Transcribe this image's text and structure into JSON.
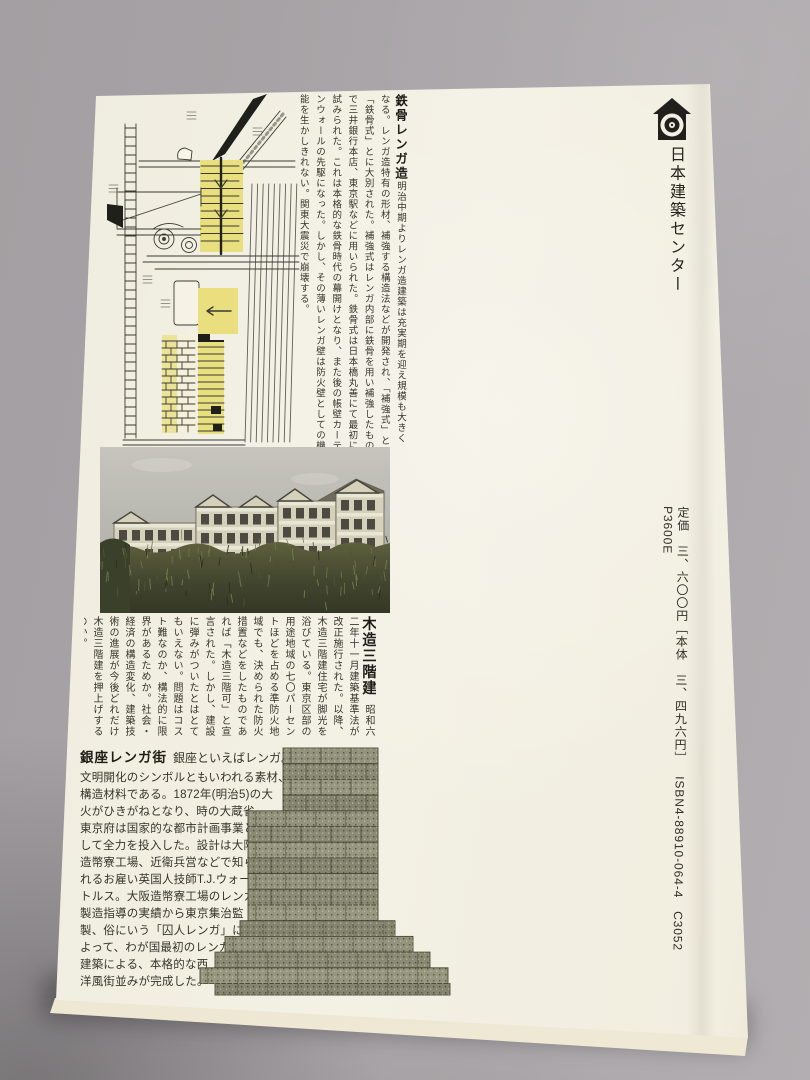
{
  "scene": {
    "backdrop_color": "#a7a3a6",
    "cover_color": "#f2efe2",
    "highlight_yellow": "#e9df7e",
    "brick_color": "#8e8e79"
  },
  "publisher": {
    "name": "日本建築センター",
    "logo_icon": "house-target-logo"
  },
  "colophon": {
    "price": "定価　三、六〇〇円［本体　三、四九六円］",
    "isbn": "ISBN4-88910-064-4　C3052　P3600E"
  },
  "articles": {
    "tekkotsu": {
      "title": "鉄骨レンガ造",
      "body": "明治中期よりレンガ造建築は充実期を迎え規模も大きくなる。レンガ造特有の形材、補強する構造法などが開発され、「補強式」と「鉄骨式」とに大別された。補強式はレンガ内部に鉄骨を用い補強したもので三井銀行本店、東京駅などに用いられた。鉄骨式は日本橋丸善にて最初に試みられた。これは本格的な鉄骨時代の幕開けとなり、また後の帳壁カーテンウォールの先駆になった。しかし、その薄いレンガ壁は防火壁としての機能を生かしきれない。関東大震災で崩壊する。"
    },
    "mokuzo": {
      "title": "木造三階建",
      "lead": "昭和六二",
      "body": "年十一月建築基準法が改正施行された。以降、木造三階建住宅が脚光を浴びている。東京区部の用途地域の七〇パーセントほどを占める準防火地域でも、決められた防火措置などをしたものであれば「木造三階可」と宣言された。しかし、建設に弾みがついたとはとてもいえない。問題はコスト難なのか、構法的に限界があるためか。社会・経済の構造変化、建築技術の進展が今後どれだけ木造三階建を押上げするのか。"
    },
    "ginza": {
      "title": "銀座レンガ街",
      "lead": "銀座といえばレンガ。",
      "body": "文明開化のシンボルともいわれる素材、\n構造材料である。1872年(明治5)の大\n火がひきがねとなり、時の大蔵省、\n東京府は国家的な都市計画事業と\nして全力を投入した。設計は大阪\n造幣寮工場、近衛兵営などで知ら\nれるお雇い英国人技師T.J.ウォー\nトルス。大阪造幣寮工場のレンガ\n製造指導の実績から東京集治監\n製、俗にいう「囚人レンガ」に\nよって、わが国最初のレンガ造\n建築による、本格的な西\n洋風街並みが完成した。"
    }
  }
}
